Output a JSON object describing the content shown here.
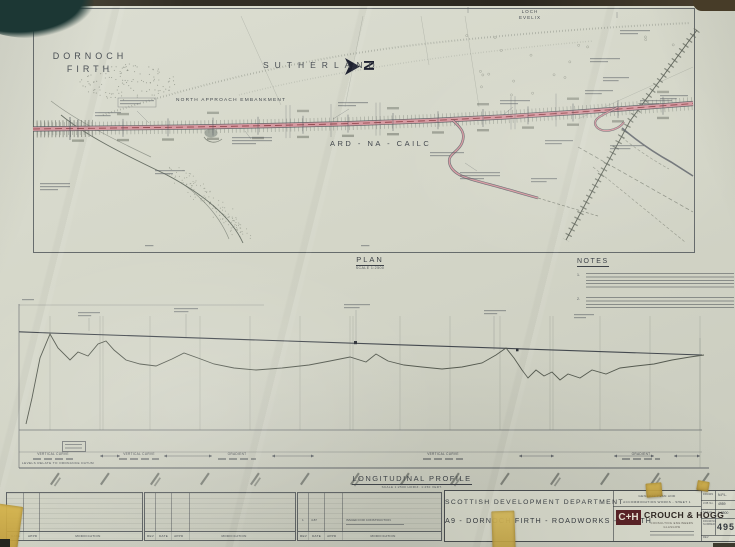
{
  "plan": {
    "region_labels": {
      "dornoch1": "DORNOCH",
      "dornoch2": "FIRTH",
      "sutherland": "SUTHERLAND",
      "loch1": "LOCH",
      "loch2": "EVELIX",
      "ard": "ARD - NA - CAILC",
      "embankment": "NORTH APPROACH EMBANKMENT"
    },
    "north_arrow_letter": "N",
    "caption": "PLAN",
    "scale": "SCALE 1:2500"
  },
  "notes": {
    "heading": "NOTES",
    "n1": "1.",
    "n2": "2."
  },
  "profile": {
    "caption": "LONGITUDINAL PROFILE",
    "scale": "SCALE 1:2500 HORIZ.  1:250 VERT.",
    "datum_note": "LEVELS RELATE TO ORDNANCE DATUM",
    "ann": {
      "vertical_curve": "VERTICAL CURVE",
      "gradient": "GRADIENT"
    }
  },
  "revision_table": {
    "h_rev": "REV",
    "h_date": "DATE",
    "h_appd": "APPD",
    "h_mod": "MODIFICATION",
    "entry_rev": "1",
    "entry_date": "4.87",
    "entry_text": "ISSUED FOR CONSTRUCTION"
  },
  "title_block": {
    "department": "SCOTTISH DEVELOPMENT DEPARTMENT",
    "project": "A9 - DORNOCH FIRTH - ROADWORKS - NORTH",
    "works1": "GENERAL PLAN AND",
    "works2": "ACCOMMODATION WORKS - SHEET 1",
    "logo": "C+H",
    "firm": "CROUCH & HOGG",
    "firm_sub1": "CONSULTING ENGINEERS",
    "firm_sub2": "GLASGOW",
    "f_drawn_l": "DRAWN",
    "f_drawn_v": "N.P.L.",
    "f_job_l": "JOB No.",
    "f_job_v": "4959",
    "f_scale_l": "SCALE",
    "f_scale_v": "1:2500",
    "f_num_l": "DRAWING NUMBER",
    "f_num_v": "4959",
    "f_rev_l": "REV"
  },
  "colors": {
    "paper": "#d4d6c8",
    "ink": "#44494f",
    "road_pink": "#d69aa1",
    "road_centerline": "#8d3f46",
    "tape": "#c9a43e",
    "logo_red": "#5a2125"
  }
}
